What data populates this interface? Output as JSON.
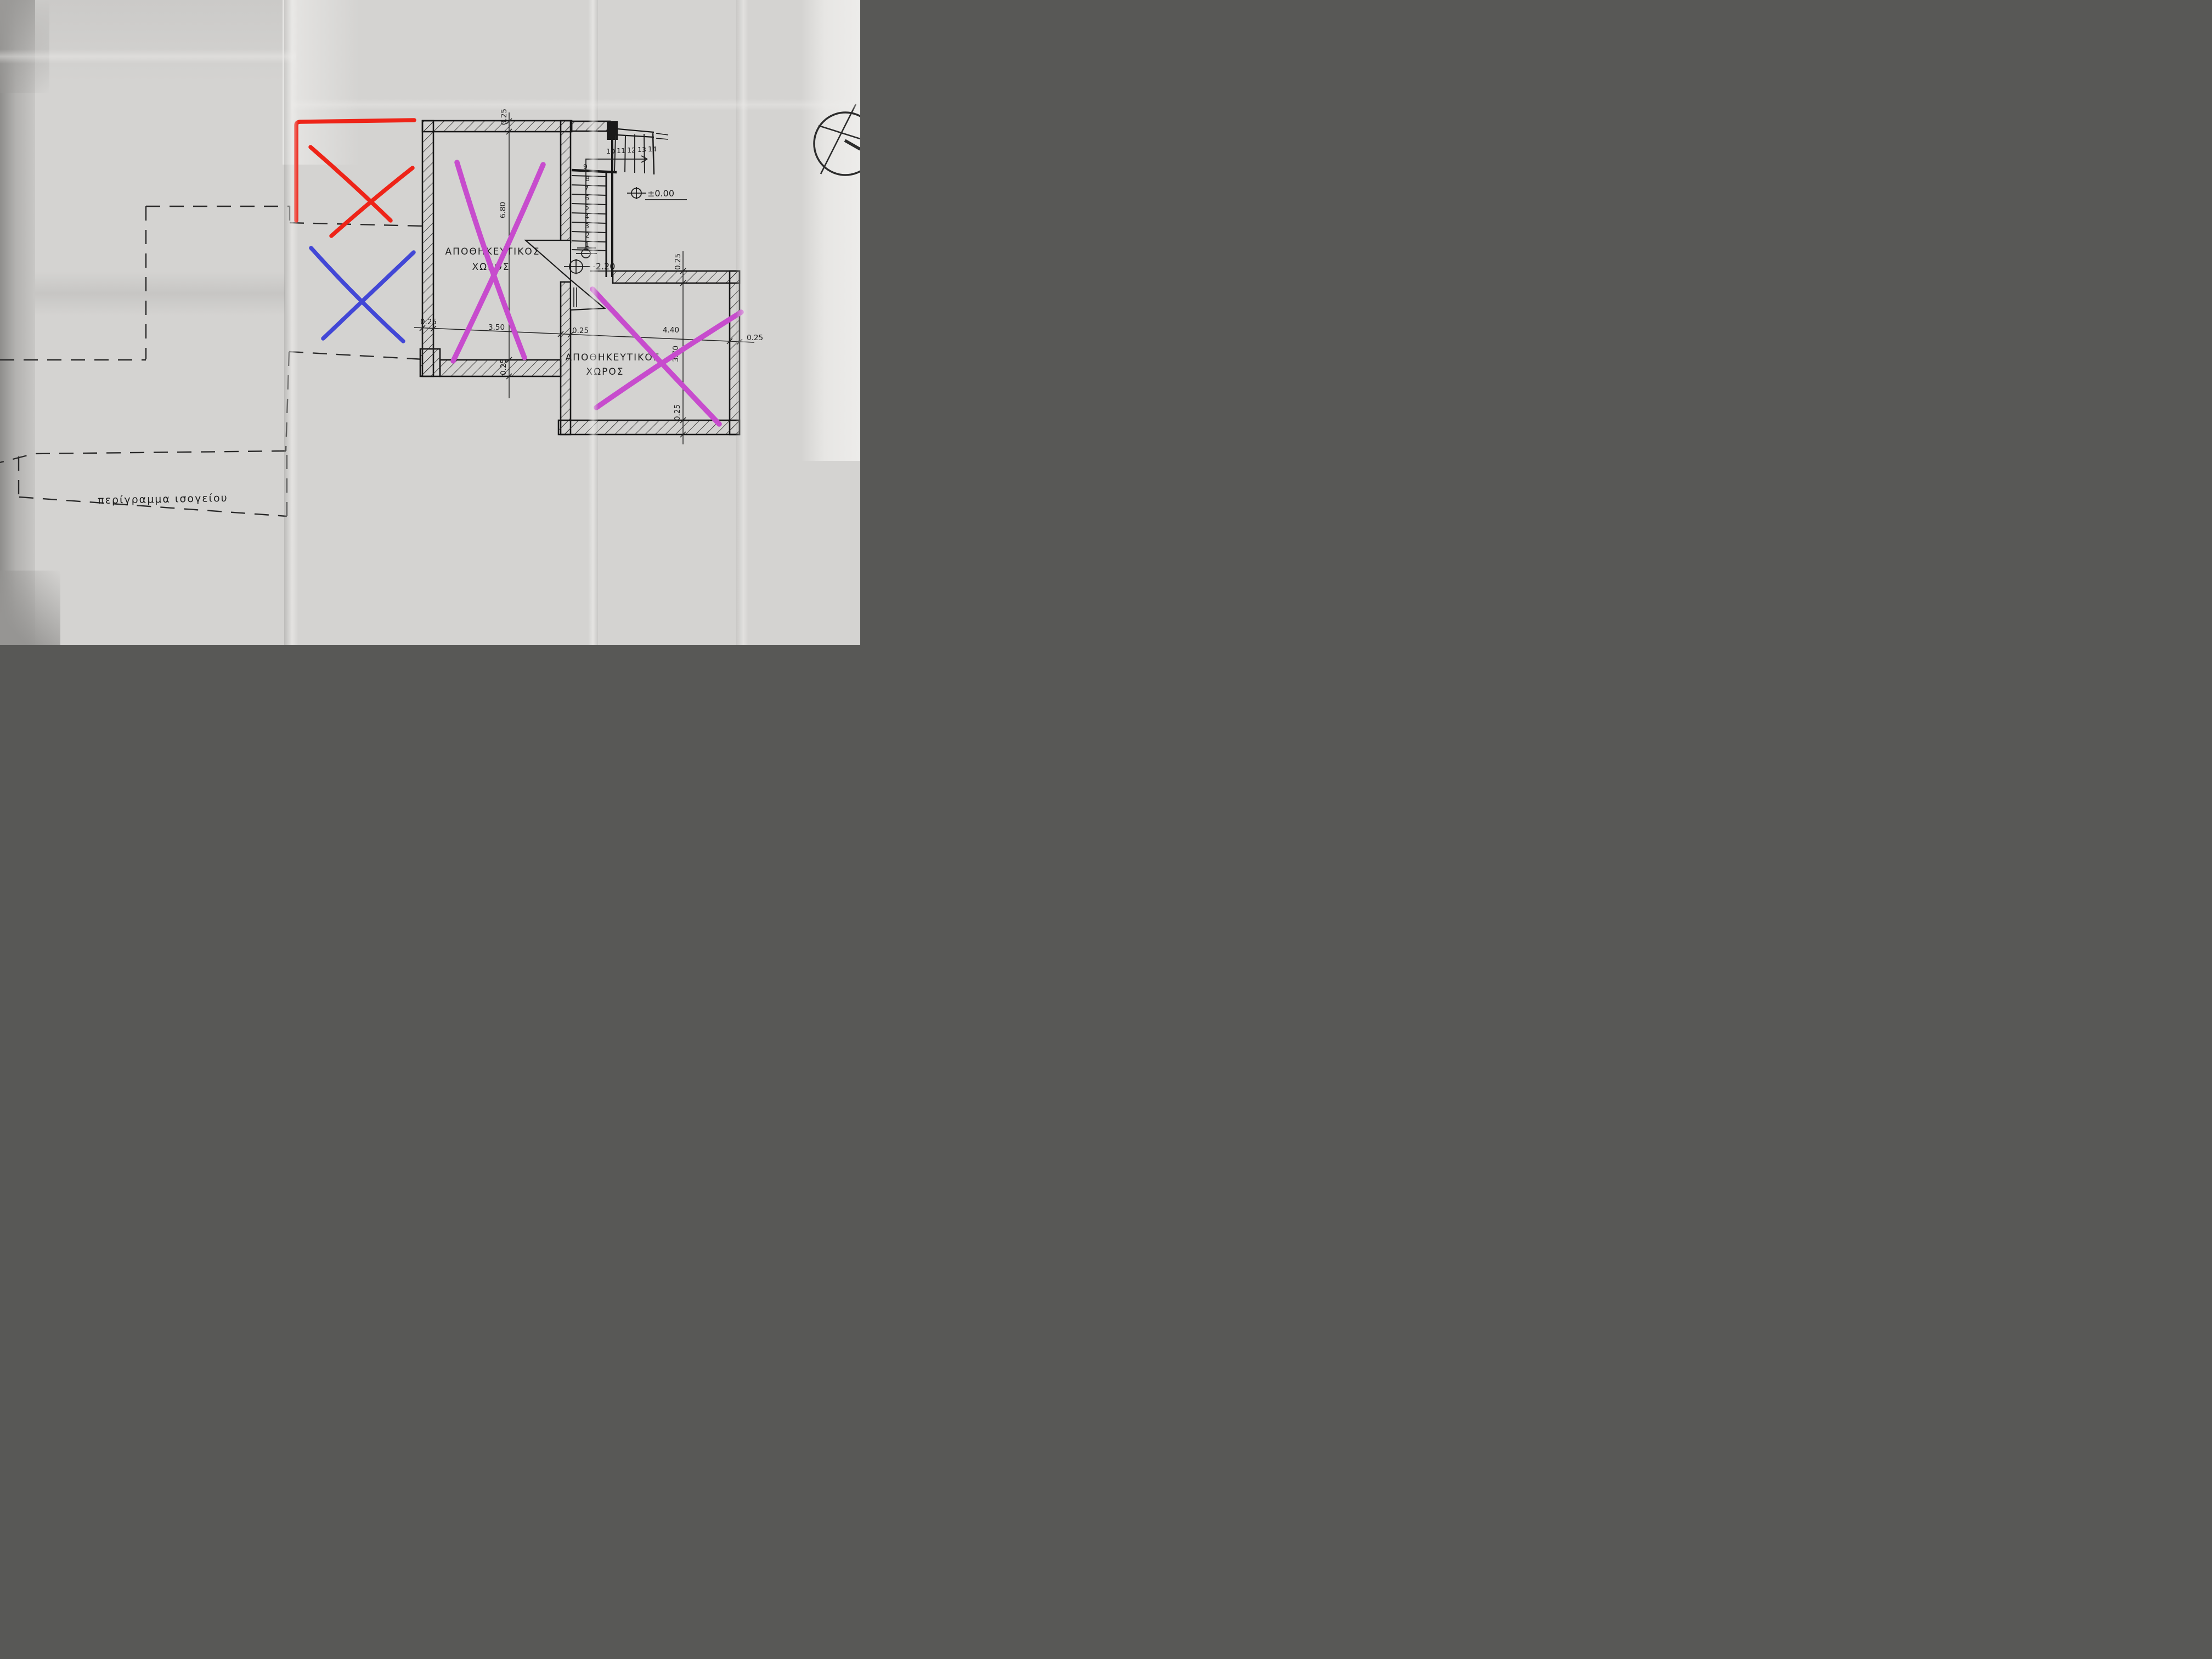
{
  "paper": {
    "description": "folded architectural blueprint photo",
    "base_color": "#d4d3d1",
    "ink_color": "#1b1b1b"
  },
  "annotations": {
    "red_color": "#ee2418",
    "blue_color": "#4247d6",
    "magenta_color": "#c74ccd",
    "red_mark": "red corner outline with X",
    "blue_mark": "blue X",
    "magenta_marks": "magenta X over each storage room"
  },
  "plan": {
    "room1": {
      "label_line1": "ΑΠΟΘΗΚΕΥΤΙΚΟΣ",
      "label_line2": "ΧΩΡΟΣ"
    },
    "room2": {
      "label_line1": "ΑΠΟΘΗΚΕΥΤΙΚΟΣ",
      "label_line2": "ΧΩΡΟΣ"
    },
    "ground_outline_label": "περίγραμμα ισογείου",
    "levels": {
      "ground": "±0.00",
      "basement": "-2.20"
    },
    "dimensions": {
      "room1_wall_top": "0.25",
      "room1_depth": "6.80",
      "room1_wall_bottom": "0.25",
      "chain_wall_left": "0.25",
      "room1_width": "3.50",
      "chain_wall_mid": "0.25",
      "room2_width": "4.40",
      "chain_wall_right": "0.25",
      "room2_wall_top": "0.25",
      "room2_depth": "3.70",
      "room2_wall_bottom": "0.25"
    },
    "stairs": {
      "numbers": [
        "1",
        "2",
        "3",
        "4",
        "5",
        "6",
        "7",
        "8",
        "9",
        "10",
        "11",
        "12",
        "13",
        "14"
      ]
    }
  }
}
